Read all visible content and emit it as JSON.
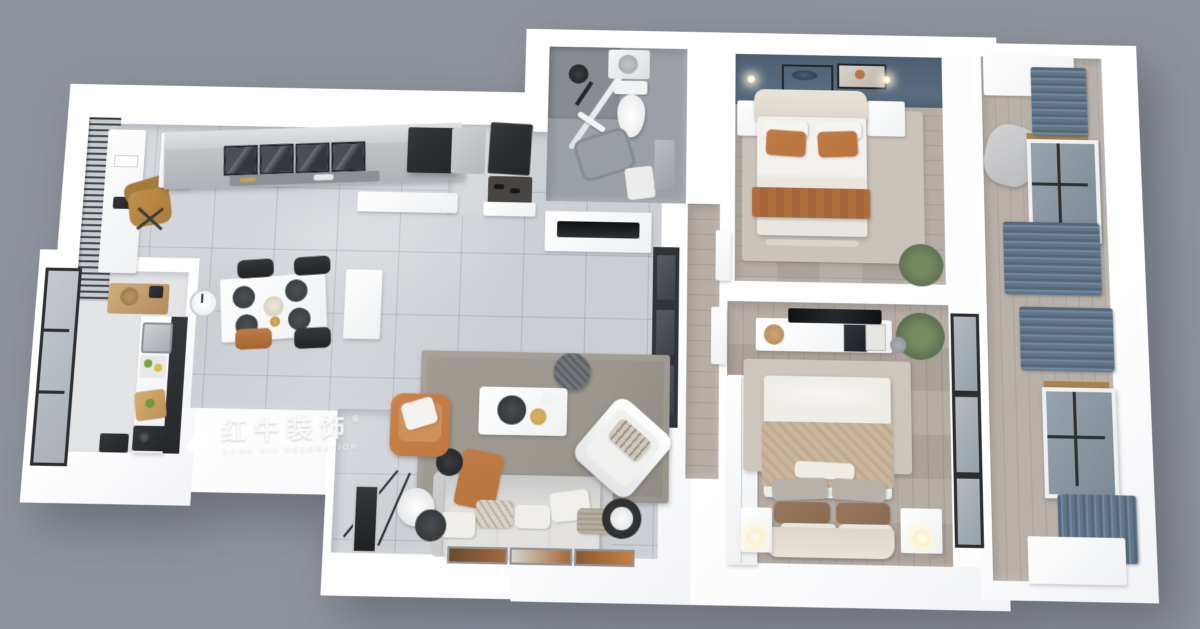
{
  "watermark": {
    "brand_cn": "红牛装饰",
    "brand_en": "HONG NIU DECORATION",
    "registered": "®"
  },
  "palette": {
    "background": "#8e939d",
    "wall": "#ffffff",
    "tile": "#cbcfd4",
    "wood": "#b2a89e",
    "balcony_wood": "#b9b1a8",
    "kitchen_floor": "#e3e4e6",
    "entry_floor": "#d8d9db",
    "bath_tile": "#9aa0a5",
    "shower_tile": "#868c91",
    "accent_wall": "#5c7083",
    "curtain": "#64798b",
    "rust": "#b9743f",
    "orange_chair": "#c07a42",
    "rug_living": "#9b968e",
    "rug_bedroom": "#cac3b9",
    "dark_fixture": "#2e3134",
    "tan_blanket": "#c9b59d",
    "plant_green": "#5f7355",
    "gold": "#c9a24b"
  }
}
